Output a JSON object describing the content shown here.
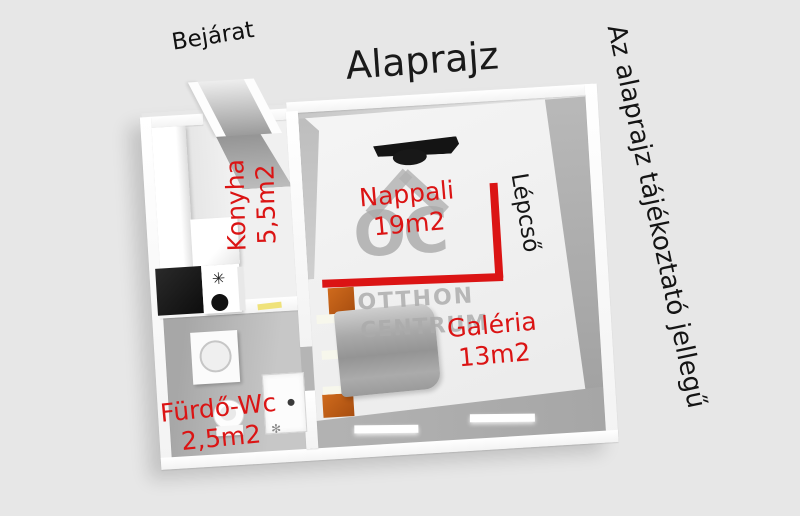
{
  "title": "Alaprajz",
  "entrance": "Bejárat",
  "disclaimer": "Az alaprajz tájékoztató jellegű",
  "rooms": {
    "kitchen": {
      "name": "Konyha",
      "area": "5,5m2"
    },
    "living": {
      "name": "Nappali",
      "area": "19m2"
    },
    "gallery": {
      "name": "Galéria",
      "area": "13m2"
    },
    "bathroom": {
      "name": "Fürdő-Wc",
      "area": "2,5m2"
    },
    "stairs": {
      "name": "Lépcső"
    }
  },
  "watermark": {
    "monogram": "OC",
    "line1": "OTTHON",
    "line2": "CENTRUM"
  },
  "icons": {
    "burner": "✳",
    "shower_spray": "✻"
  },
  "colors": {
    "background": "#e7e7e7",
    "label_red": "#db1414",
    "bed_orange": "#bf5a14",
    "watermark_gray": "#ababab",
    "stairs_line_red": "#db1414"
  }
}
